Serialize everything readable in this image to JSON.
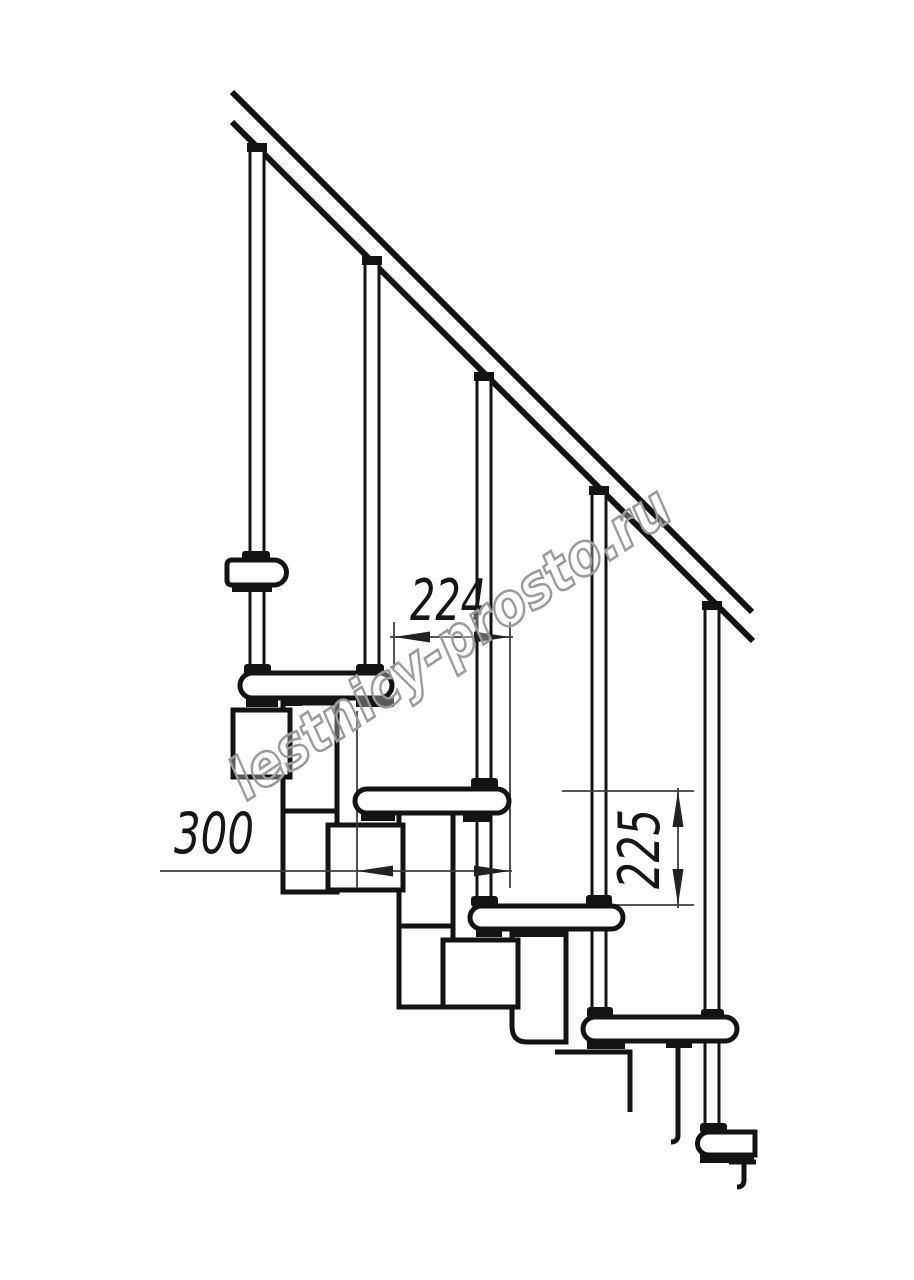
{
  "canvas": {
    "width": 914,
    "height": 1280,
    "background": "#ffffff"
  },
  "drawing": {
    "watermark": {
      "text": "lestnicy-prosto.ru"
    },
    "dimensions": {
      "tread_overlap": {
        "value": "224",
        "orientation": "horizontal"
      },
      "tread_depth": {
        "value": "300",
        "orientation": "horizontal"
      },
      "step_rise": {
        "value": "225",
        "orientation": "vertical"
      }
    },
    "colors": {
      "outline": "#131313",
      "dimension_line": "#3d3d3d",
      "watermark": "#9a9a9a",
      "background": "#ffffff"
    }
  }
}
